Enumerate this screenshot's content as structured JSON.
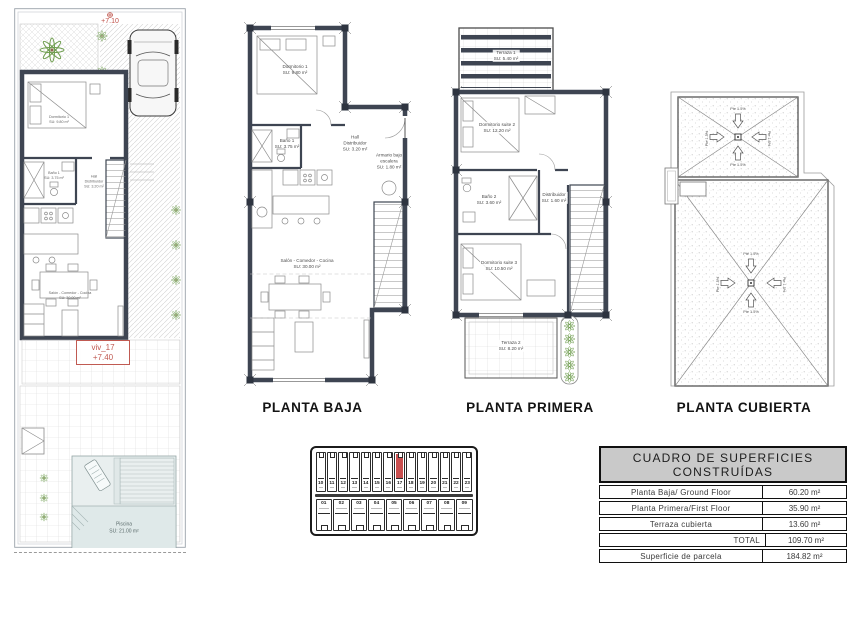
{
  "site_plan": {
    "benchmark_elevation": "+7.10",
    "unit_label": "viv_17",
    "unit_elevation": "+7.40",
    "pool_name": "Piscina",
    "pool_area": "SU: 21.00 m²"
  },
  "planta_baja": {
    "title": "PLANTA BAJA",
    "rooms": {
      "dormitorio1": {
        "name": "Dormitorio 1",
        "area": "SU: 9.80 m²"
      },
      "bano1": {
        "name": "Baño 1",
        "area": "SU: 3.75 m²"
      },
      "hall": {
        "name": "Hall",
        "name2": "Distribuidor",
        "area": "SU: 3.20 m²"
      },
      "armario": {
        "name": "Armario bajo",
        "name2": "escalera",
        "area": "SU: 1.80 m²"
      },
      "salon": {
        "name": "Salón - Comedor - Cocina",
        "area": "SU: 30.00 m²"
      }
    }
  },
  "planta_primera": {
    "title": "PLANTA PRIMERA",
    "rooms": {
      "terraza1": {
        "name": "Terraza 1",
        "area": "SU: 5.40 m²"
      },
      "suite2": {
        "name": "Dormitorio suite 2",
        "area": "SU: 12.20 m²"
      },
      "bano2": {
        "name": "Baño 2",
        "area": "SU: 3.60 m²"
      },
      "distribuidor": {
        "name": "Distribuidor",
        "area": "SU: 1.60 m²"
      },
      "suite3": {
        "name": "Dormitorio suite 3",
        "area": "SU: 10.50 m²"
      },
      "terraza2": {
        "name": "Terraza 2",
        "area": "SU: 8.20 m²"
      }
    }
  },
  "planta_cubierta": {
    "title": "PLANTA CUBIERTA",
    "slope_label": "Pte 1.5%"
  },
  "key_plan": {
    "top_row": [
      "10",
      "11",
      "12",
      "13",
      "14",
      "15",
      "16",
      "17",
      "18",
      "19",
      "20",
      "21",
      "22",
      "23"
    ],
    "bottom_row": [
      "01",
      "02",
      "03",
      "04",
      "05",
      "06",
      "07",
      "08",
      "09"
    ],
    "highlighted_unit": "17"
  },
  "areas_table": {
    "title": "CUADRO DE SUPERFICIES CONSTRUÍDAS",
    "rows": [
      {
        "label": "Planta Baja/ Ground Floor",
        "value": "60.20 m²"
      },
      {
        "label": "Planta Primera/First Floor",
        "value": "35.90 m²"
      },
      {
        "label": "Terraza cubierta",
        "value": "13.60 m²"
      },
      {
        "label": "TOTAL",
        "value": "109.70 m²"
      },
      {
        "label": "Superficie de parcela",
        "value": "184.82 m²"
      }
    ]
  }
}
